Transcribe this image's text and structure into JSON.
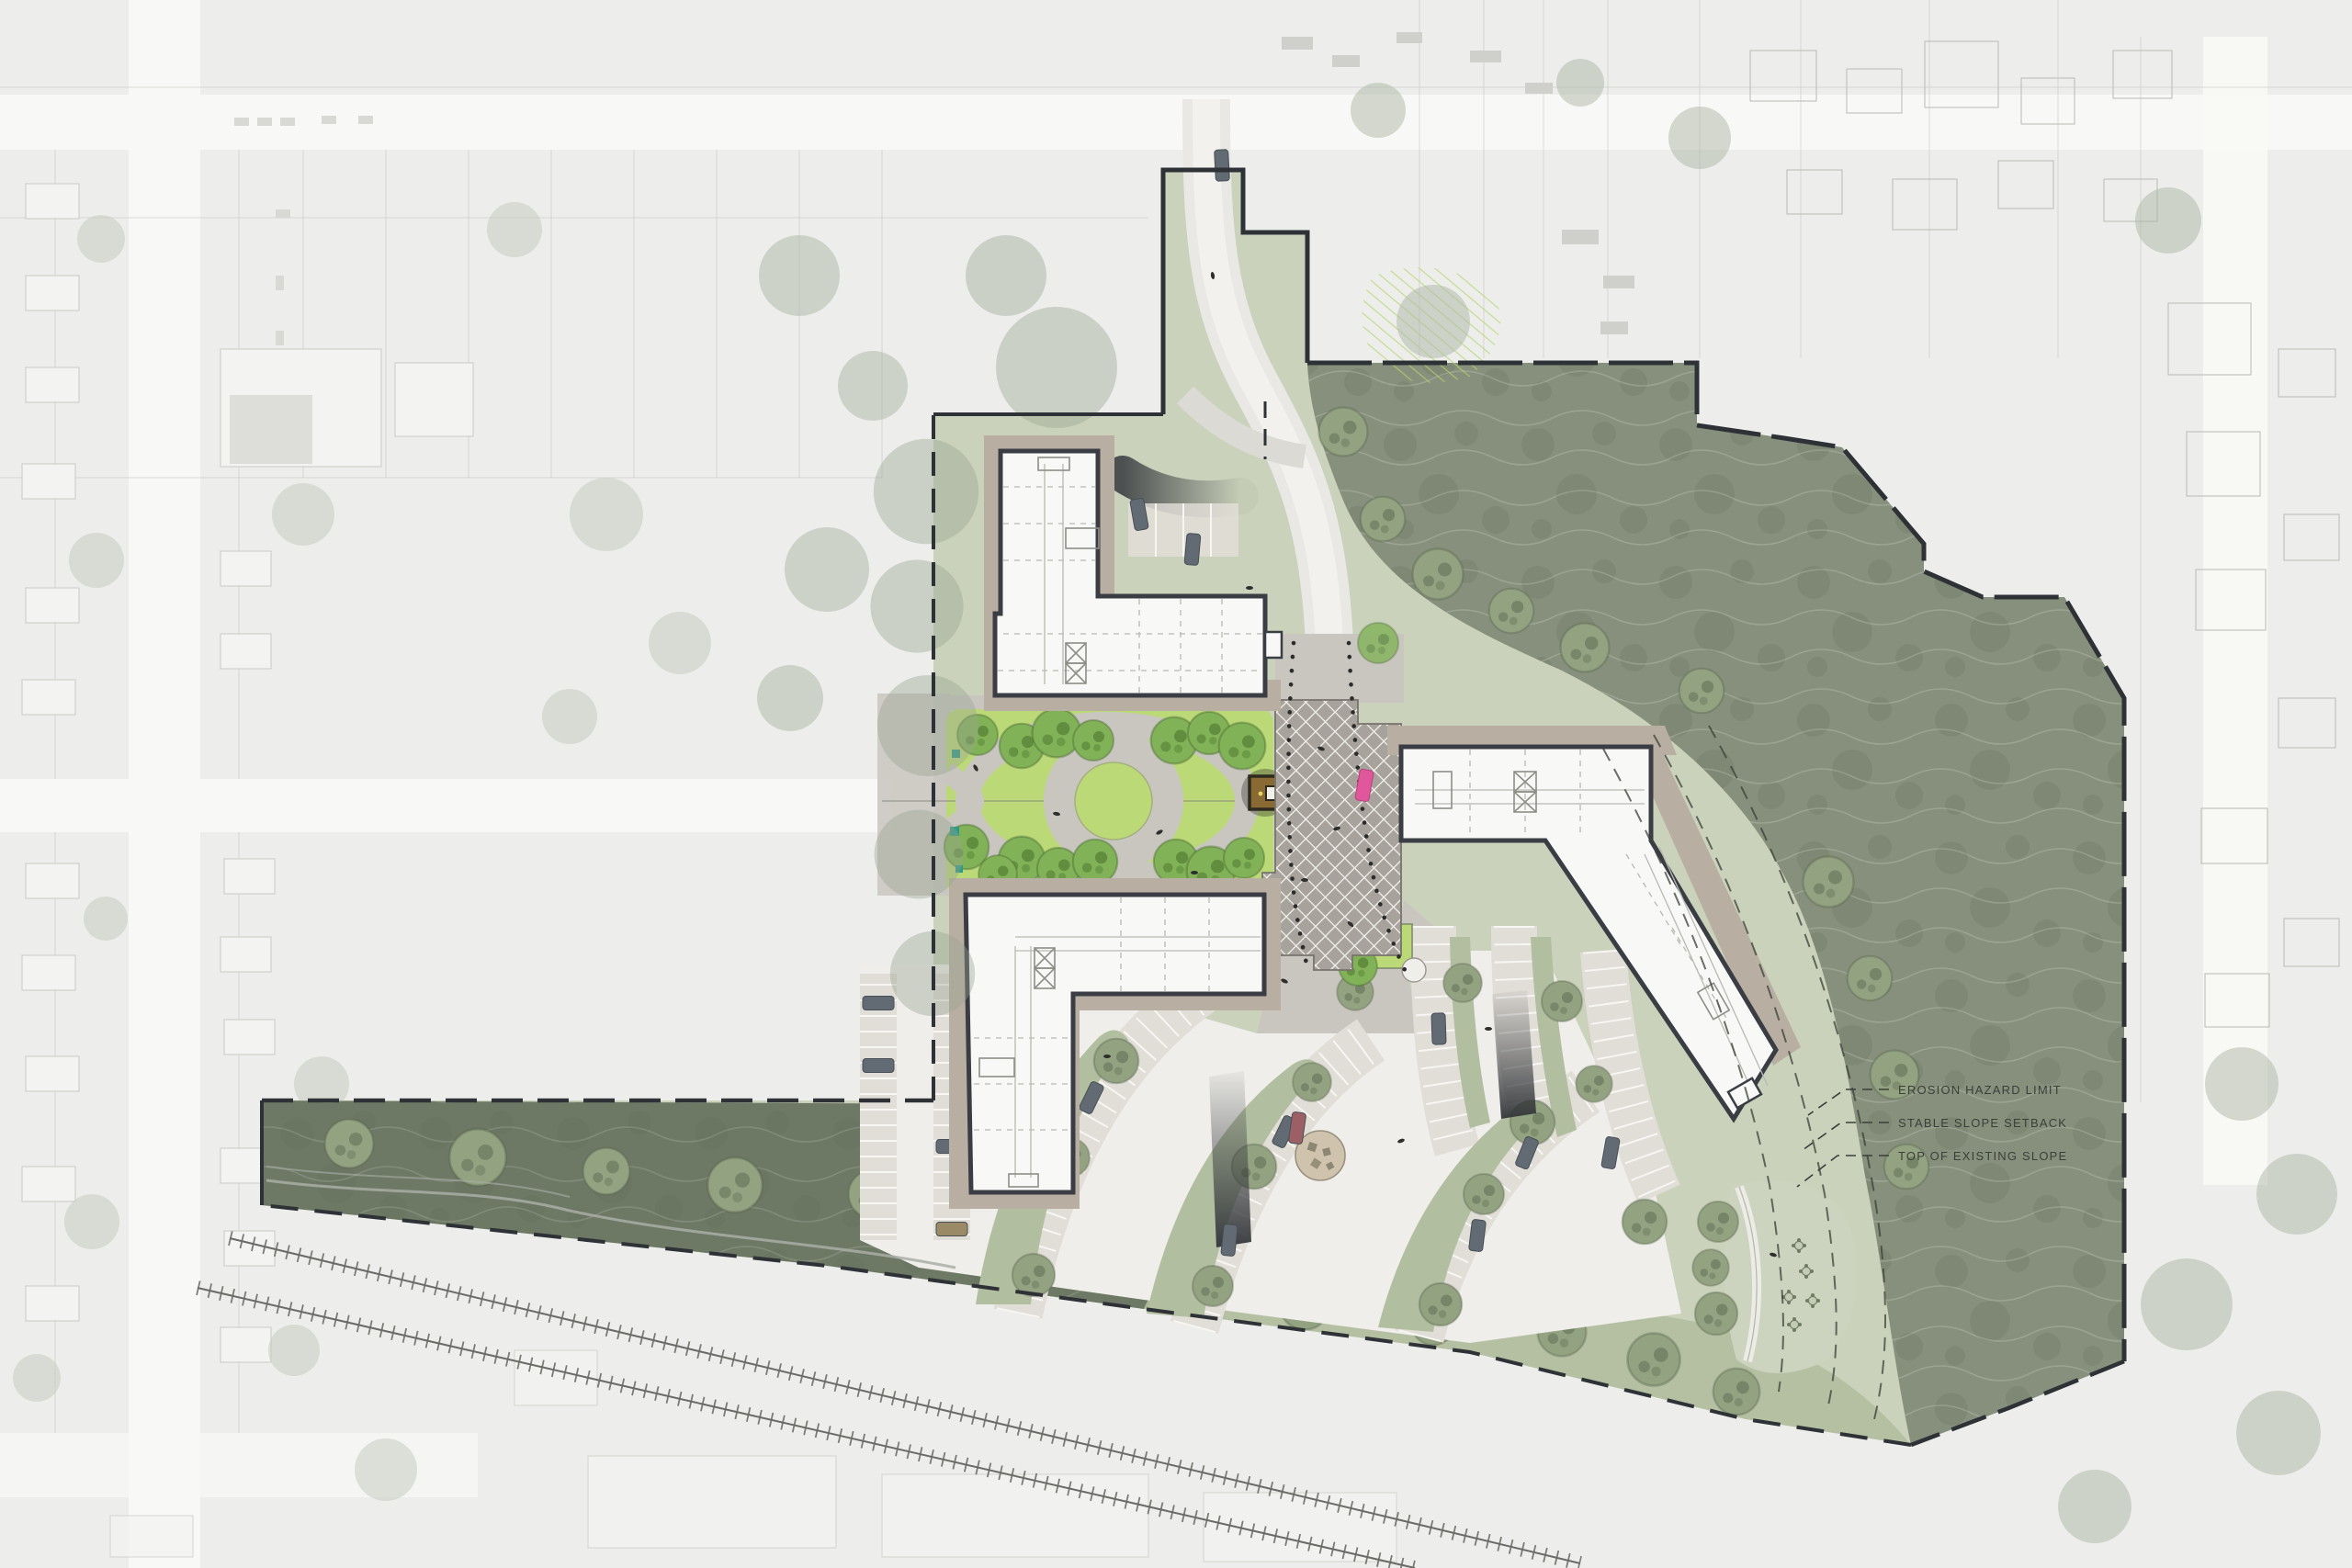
{
  "plan": {
    "annotations": [
      {
        "label": "EROSION HAZARD LIMIT"
      },
      {
        "label": "STABLE SLOPE SETBACK"
      },
      {
        "label": "TOP OF EXISTING SLOPE"
      }
    ]
  },
  "palette": {
    "forest": "#87907c",
    "forestDark": "#6e7965",
    "sage": "#c8d0b8",
    "sageMed": "#b2bea0",
    "lawnBright": "#bcd977",
    "treeBright": "#82b258",
    "treeSage": "#93a281",
    "tan": "#b8afa2",
    "paving": "#c9c6c0",
    "plaza": "#a7a29b",
    "building": "#f8f8f6",
    "outline": "#3a3e44",
    "asphalt": "#efeeea",
    "stall": "#e1ddd7",
    "carGray": "#626a73",
    "carPink": "#e0579b",
    "boundary": "#2e3236",
    "aerialBase": "#edeeec",
    "aerialRoad": "#f8f8f6"
  }
}
